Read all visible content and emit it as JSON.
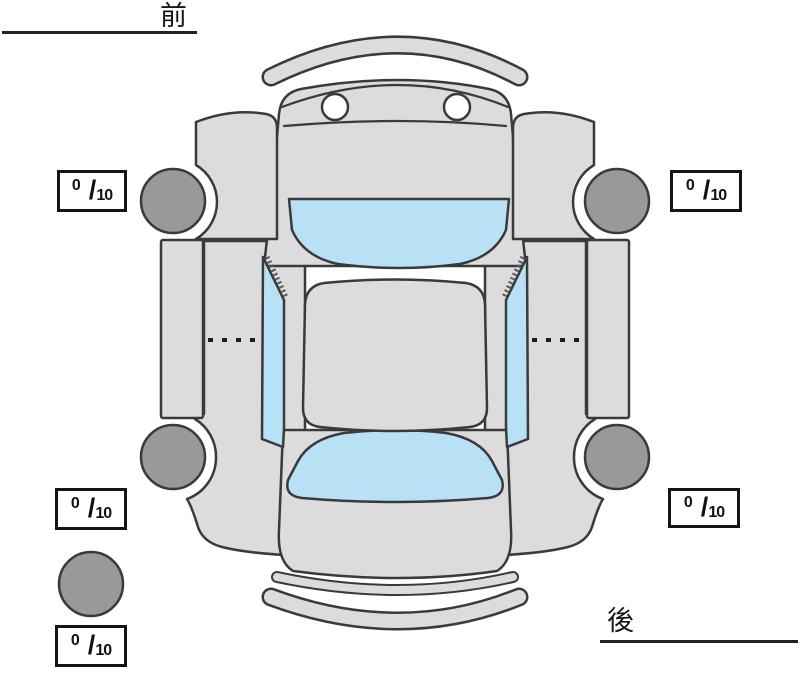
{
  "orientation": {
    "front_label": "前",
    "rear_label": "後"
  },
  "tread_boxes": [
    {
      "position": "front-left",
      "value": "0",
      "separator": "/",
      "max": "10"
    },
    {
      "position": "front-right",
      "value": "0",
      "separator": "/",
      "max": "10"
    },
    {
      "position": "rear-left",
      "value": "0",
      "separator": "/",
      "max": "10"
    },
    {
      "position": "rear-right",
      "value": "0",
      "separator": "/",
      "max": "10"
    },
    {
      "position": "spare",
      "value": "0",
      "separator": "/",
      "max": "10"
    }
  ],
  "diagram": {
    "type": "car-top-view",
    "view": "birds-eye",
    "parts": [
      "front-bumper",
      "cowl",
      "hood",
      "windshield",
      "roof",
      "rear-window",
      "trunk",
      "rear-bumper",
      "left-front-fender",
      "right-front-fender",
      "left-side-panel",
      "right-side-panel",
      "left-door-sill",
      "right-door-sill",
      "left-side-window",
      "right-side-window",
      "tire-front-left",
      "tire-front-right",
      "tire-rear-left",
      "tire-rear-right",
      "spare-tire"
    ],
    "colors": {
      "body": "#dcdcdc",
      "tire": "#999999",
      "glass": "#b8e1f6",
      "outline": "#3a3a3a",
      "background": "#ffffff",
      "box_border": "#151515",
      "text": "#161616"
    }
  }
}
